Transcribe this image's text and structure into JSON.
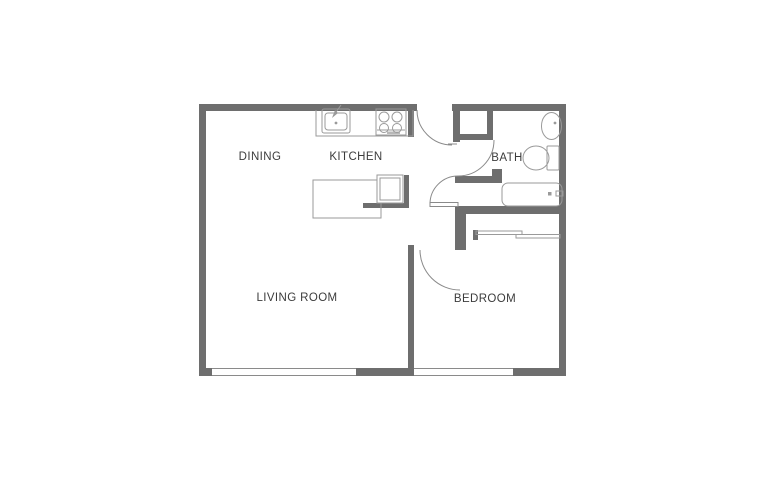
{
  "title": "One-bedroom apartment floor plan",
  "rooms": {
    "dining": {
      "label": "DINING"
    },
    "kitchen": {
      "label": "KITCHEN"
    },
    "bath": {
      "label": "BATH"
    },
    "living": {
      "label": "LIVING ROOM"
    },
    "bedroom": {
      "label": "BEDROOM"
    }
  },
  "fixtures": [
    "kitchen-counter",
    "kitchen-sink",
    "stove",
    "kitchen-island",
    "dishwasher",
    "entry-door",
    "hall-door",
    "bath-door",
    "bedroom-door",
    "bath-closet",
    "pedestal-sink",
    "toilet",
    "bathtub",
    "bedroom-closet-sliding-doors",
    "living-room-window",
    "bedroom-window"
  ],
  "colors": {
    "wall": "#6e6e6e",
    "fixture_line": "#9a9a9a",
    "door_line": "#8a8a8a",
    "label_text": "#3c3c3c",
    "background": "#ffffff"
  }
}
